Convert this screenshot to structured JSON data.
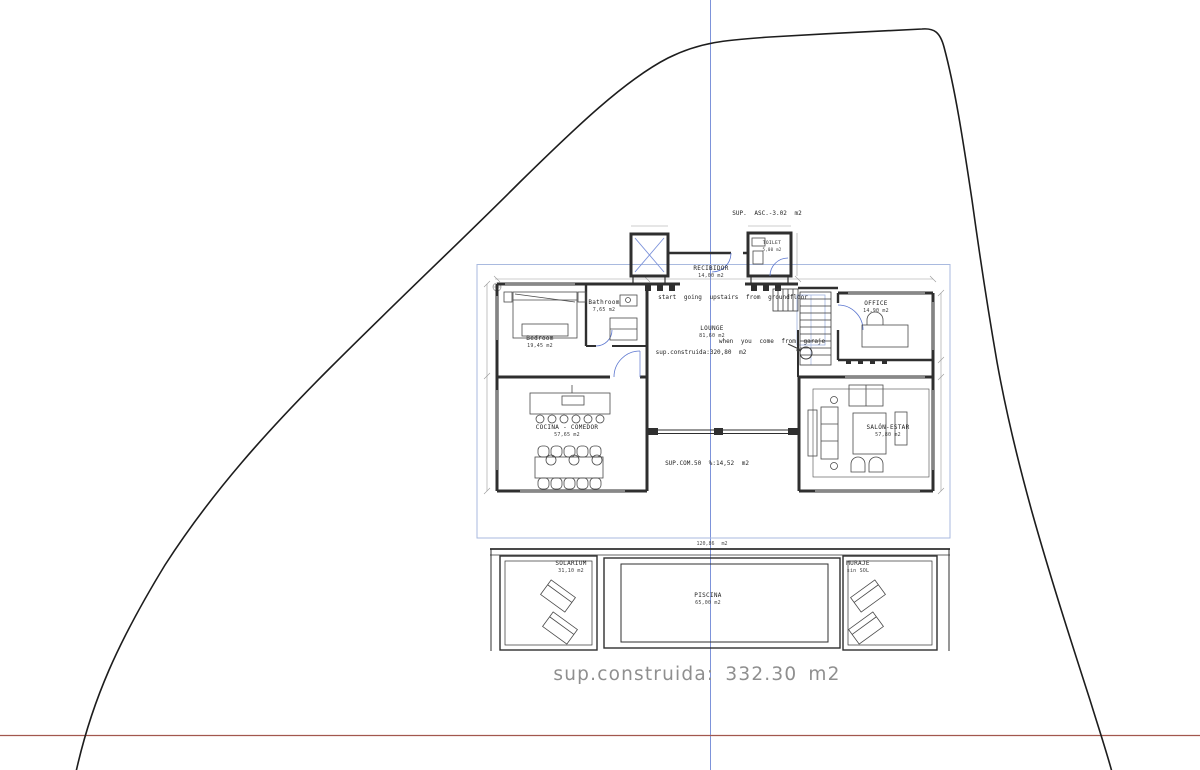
{
  "colors": {
    "wall": "#2f2f2f",
    "furniture": "#4a4a4a",
    "guide_blue": "#7d93da",
    "guide_blue_light": "#a9badf",
    "door_blue": "#5b76cf",
    "datum_red": "#a2574e",
    "dim_gray": "#9a9a9a",
    "total_text_gray": "#8f8f8f"
  },
  "annotations": {
    "sup_asc": "SUP. ASC.-3.02 m2",
    "upstairs_note": "start going upstairs from groundfloor",
    "garaje_note": "when you come from garaje",
    "interior_area": "sup.construida:320,80 m2",
    "common_area": "SUP.COM.50 %:14,52 m2",
    "terrace_dim": "120,86 m2",
    "total_area": "sup.construida: 332.30 m2"
  },
  "rooms": [
    {
      "name": "RECIBIDOR",
      "area": "14,00 m2"
    },
    {
      "name": "TOILET",
      "area": "5,00 m2"
    },
    {
      "name": "Bedroom",
      "area": "19,45 m2"
    },
    {
      "name": "Bathroom",
      "area": "7,65 m2"
    },
    {
      "name": "LOUNGE",
      "area": "81,60 m2"
    },
    {
      "name": "OFFICE",
      "area": "14,90 m2"
    },
    {
      "name": "COCINA - COMEDOR",
      "area": "57,65 m2"
    },
    {
      "name": "SALÓN-ESTAR",
      "area": "57,80 m2"
    },
    {
      "name": "SOLARIUM",
      "area": "31,10 m2"
    },
    {
      "name": "PISCINA",
      "area": "65,00 m2"
    },
    {
      "name": "MURAJE",
      "area": "sin SOL"
    }
  ]
}
